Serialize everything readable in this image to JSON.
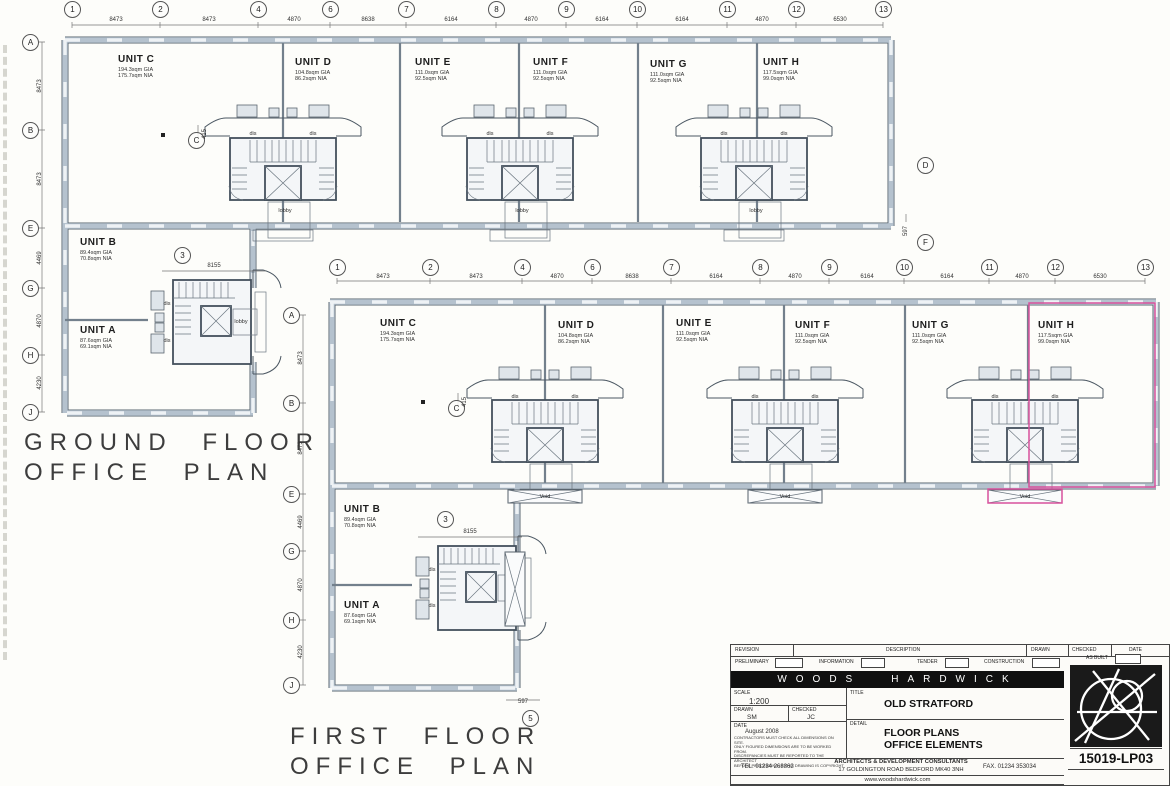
{
  "sheet": {
    "bg": "#fdfdfa",
    "line": "#3c3c3c",
    "wall_color": "#b5c2ce",
    "highlight_pink": "#d8519c"
  },
  "labels": {
    "dis": "dis",
    "lobby": "lobby",
    "void": "Void"
  },
  "plans": [
    {
      "id": "ground-floor",
      "title": {
        "line1": "GROUND FLOOR",
        "line2": "OFFICE PLAN",
        "x": 24,
        "y": 428
      },
      "bubbles": [
        {
          "label": "1",
          "x": 72,
          "y": 9
        },
        {
          "label": "2",
          "x": 160,
          "y": 9
        },
        {
          "label": "4",
          "x": 258,
          "y": 9
        },
        {
          "label": "6",
          "x": 330,
          "y": 9
        },
        {
          "label": "7",
          "x": 406,
          "y": 9
        },
        {
          "label": "8",
          "x": 496,
          "y": 9
        },
        {
          "label": "9",
          "x": 566,
          "y": 9
        },
        {
          "label": "10",
          "x": 637,
          "y": 9
        },
        {
          "label": "11",
          "x": 727,
          "y": 9
        },
        {
          "label": "12",
          "x": 796,
          "y": 9
        },
        {
          "label": "13",
          "x": 883,
          "y": 9
        },
        {
          "label": "A",
          "x": 30,
          "y": 42
        },
        {
          "label": "B",
          "x": 30,
          "y": 130
        },
        {
          "label": "E",
          "x": 30,
          "y": 228
        },
        {
          "label": "G",
          "x": 30,
          "y": 288
        },
        {
          "label": "H",
          "x": 30,
          "y": 355
        },
        {
          "label": "J",
          "x": 30,
          "y": 412
        },
        {
          "label": "D",
          "x": 925,
          "y": 165
        },
        {
          "label": "F",
          "x": 925,
          "y": 242
        },
        {
          "label": "3",
          "x": 182,
          "y": 255
        },
        {
          "label": "C",
          "x": 196,
          "y": 140
        }
      ],
      "dims": [
        {
          "v": "8473",
          "x": 116,
          "y": 20
        },
        {
          "v": "8473",
          "x": 209,
          "y": 20
        },
        {
          "v": "4870",
          "x": 294,
          "y": 20
        },
        {
          "v": "8638",
          "x": 368,
          "y": 20
        },
        {
          "v": "6164",
          "x": 451,
          "y": 20
        },
        {
          "v": "4870",
          "x": 531,
          "y": 20
        },
        {
          "v": "6164",
          "x": 602,
          "y": 20
        },
        {
          "v": "6164",
          "x": 682,
          "y": 20
        },
        {
          "v": "4870",
          "x": 762,
          "y": 20
        },
        {
          "v": "6530",
          "x": 840,
          "y": 20
        },
        {
          "v": "8473",
          "x": 40,
          "y": 86,
          "rot": 1
        },
        {
          "v": "8473",
          "x": 40,
          "y": 179,
          "rot": 1
        },
        {
          "v": "4469",
          "x": 40,
          "y": 258,
          "rot": 1
        },
        {
          "v": "4870",
          "x": 40,
          "y": 321,
          "rot": 1
        },
        {
          "v": "4230",
          "x": 40,
          "y": 383,
          "rot": 1
        },
        {
          "v": "8155",
          "x": 214,
          "y": 266
        },
        {
          "v": "597",
          "x": 906,
          "y": 231,
          "rot": 1
        },
        {
          "v": "415",
          "x": 205,
          "y": 134,
          "rot": 1
        }
      ],
      "units": [
        {
          "name": "UNIT C",
          "gia": "194.3sqm GIA",
          "nia": "175.7sqm NIA",
          "x": 118,
          "y": 54
        },
        {
          "name": "UNIT D",
          "gia": "104.8sqm GIA",
          "nia": "86.2sqm NIA",
          "x": 295,
          "y": 57
        },
        {
          "name": "UNIT E",
          "gia": "111.0sqm GIA",
          "nia": "92.5sqm NIA",
          "x": 415,
          "y": 57
        },
        {
          "name": "UNIT F",
          "gia": "111.0sqm GIA",
          "nia": "92.5sqm NIA",
          "x": 533,
          "y": 57
        },
        {
          "name": "UNIT G",
          "gia": "111.0sqm GIA",
          "nia": "92.5sqm NIA",
          "x": 650,
          "y": 59
        },
        {
          "name": "UNIT H",
          "gia": "117.5sqm GIA",
          "nia": "99.0sqm NIA",
          "x": 763,
          "y": 57
        },
        {
          "name": "UNIT B",
          "gia": "89.4sqm GIA",
          "nia": "70.8sqm NIA",
          "x": 80,
          "y": 237
        },
        {
          "name": "UNIT A",
          "gia": "87.6sqm GIA",
          "nia": "69.1sqm NIA",
          "x": 80,
          "y": 325
        }
      ],
      "texts": [
        {
          "t": "dis",
          "x": 253,
          "y": 134
        },
        {
          "t": "dis",
          "x": 313,
          "y": 134
        },
        {
          "t": "dis",
          "x": 490,
          "y": 134
        },
        {
          "t": "dis",
          "x": 550,
          "y": 134
        },
        {
          "t": "dis",
          "x": 724,
          "y": 134
        },
        {
          "t": "dis",
          "x": 784,
          "y": 134
        },
        {
          "t": "lobby",
          "x": 285,
          "y": 211
        },
        {
          "t": "lobby",
          "x": 522,
          "y": 211
        },
        {
          "t": "lobby",
          "x": 756,
          "y": 211
        },
        {
          "t": "dis",
          "x": 167,
          "y": 304
        },
        {
          "t": "dis",
          "x": 167,
          "y": 341
        },
        {
          "t": "lobby",
          "x": 241,
          "y": 322
        }
      ]
    },
    {
      "id": "first-floor",
      "title": {
        "line1": "FIRST FLOOR",
        "line2": "OFFICE PLAN",
        "x": 290,
        "y": 722
      },
      "bubbles": [
        {
          "label": "1",
          "x": 337,
          "y": 267
        },
        {
          "label": "2",
          "x": 430,
          "y": 267
        },
        {
          "label": "4",
          "x": 522,
          "y": 267
        },
        {
          "label": "6",
          "x": 592,
          "y": 267
        },
        {
          "label": "7",
          "x": 671,
          "y": 267
        },
        {
          "label": "8",
          "x": 760,
          "y": 267
        },
        {
          "label": "9",
          "x": 829,
          "y": 267
        },
        {
          "label": "10",
          "x": 904,
          "y": 267
        },
        {
          "label": "11",
          "x": 989,
          "y": 267
        },
        {
          "label": "12",
          "x": 1055,
          "y": 267
        },
        {
          "label": "13",
          "x": 1145,
          "y": 267
        },
        {
          "label": "A",
          "x": 291,
          "y": 315
        },
        {
          "label": "B",
          "x": 291,
          "y": 403
        },
        {
          "label": "E",
          "x": 291,
          "y": 494
        },
        {
          "label": "G",
          "x": 291,
          "y": 551
        },
        {
          "label": "H",
          "x": 291,
          "y": 620
        },
        {
          "label": "J",
          "x": 291,
          "y": 685
        },
        {
          "label": "C",
          "x": 456,
          "y": 408
        },
        {
          "label": "3",
          "x": 445,
          "y": 519
        },
        {
          "label": "5",
          "x": 530,
          "y": 718
        }
      ],
      "dims": [
        {
          "v": "8473",
          "x": 383,
          "y": 277
        },
        {
          "v": "8473",
          "x": 476,
          "y": 277
        },
        {
          "v": "4870",
          "x": 557,
          "y": 277
        },
        {
          "v": "8638",
          "x": 632,
          "y": 277
        },
        {
          "v": "6164",
          "x": 716,
          "y": 277
        },
        {
          "v": "4870",
          "x": 795,
          "y": 277
        },
        {
          "v": "6164",
          "x": 867,
          "y": 277
        },
        {
          "v": "6164",
          "x": 947,
          "y": 277
        },
        {
          "v": "4870",
          "x": 1022,
          "y": 277
        },
        {
          "v": "6530",
          "x": 1100,
          "y": 277
        },
        {
          "v": "8473",
          "x": 301,
          "y": 358,
          "rot": 1
        },
        {
          "v": "8473",
          "x": 301,
          "y": 448,
          "rot": 1
        },
        {
          "v": "4469",
          "x": 301,
          "y": 522,
          "rot": 1
        },
        {
          "v": "4870",
          "x": 301,
          "y": 585,
          "rot": 1
        },
        {
          "v": "4230",
          "x": 301,
          "y": 652,
          "rot": 1
        },
        {
          "v": "8155",
          "x": 470,
          "y": 532
        },
        {
          "v": "597",
          "x": 523,
          "y": 702
        },
        {
          "v": "415",
          "x": 465,
          "y": 402,
          "rot": 1
        }
      ],
      "units": [
        {
          "name": "UNIT C",
          "gia": "194.3sqm GIA",
          "nia": "175.7sqm NIA",
          "x": 380,
          "y": 318
        },
        {
          "name": "UNIT D",
          "gia": "104.8sqm GIA",
          "nia": "86.2sqm NIA",
          "x": 558,
          "y": 320
        },
        {
          "name": "UNIT E",
          "gia": "111.0sqm GIA",
          "nia": "92.5sqm NIA",
          "x": 676,
          "y": 318
        },
        {
          "name": "UNIT F",
          "gia": "111.0sqm GIA",
          "nia": "92.5sqm NIA",
          "x": 795,
          "y": 320
        },
        {
          "name": "UNIT G",
          "gia": "111.0sqm GIA",
          "nia": "92.5sqm NIA",
          "x": 912,
          "y": 320
        },
        {
          "name": "UNIT H",
          "gia": "117.5sqm GIA",
          "nia": "99.0sqm NIA",
          "x": 1038,
          "y": 320
        },
        {
          "name": "UNIT B",
          "gia": "89.4sqm GIA",
          "nia": "70.8sqm NIA",
          "x": 344,
          "y": 504
        },
        {
          "name": "UNIT A",
          "gia": "87.6sqm GIA",
          "nia": "69.1sqm NIA",
          "x": 344,
          "y": 600
        }
      ],
      "texts": [
        {
          "t": "dis",
          "x": 515,
          "y": 397
        },
        {
          "t": "dis",
          "x": 575,
          "y": 397
        },
        {
          "t": "dis",
          "x": 755,
          "y": 397
        },
        {
          "t": "dis",
          "x": 815,
          "y": 397
        },
        {
          "t": "dis",
          "x": 995,
          "y": 397
        },
        {
          "t": "dis",
          "x": 1055,
          "y": 397
        },
        {
          "t": "Void",
          "x": 545,
          "y": 497
        },
        {
          "t": "Void",
          "x": 785,
          "y": 497
        },
        {
          "t": "Void",
          "x": 1025,
          "y": 497
        },
        {
          "t": "dis",
          "x": 432,
          "y": 570
        },
        {
          "t": "dis",
          "x": 432,
          "y": 606
        }
      ]
    }
  ],
  "titleblock": {
    "revision_label": "REVISION",
    "description_label": "DESCRIPTION",
    "drawn_label": "DRAWN",
    "checked_label": "CHECKED",
    "date_label": "DATE",
    "statuses": [
      "PRELIMINARY",
      "INFORMATION",
      "TENDER",
      "CONSTRUCTION",
      "AS BUILT"
    ],
    "firm_word1": "WOODS",
    "firm_word2": "HARDWICK",
    "scale_label": "SCALE",
    "scale_value": "1:200",
    "title_label": "TITLE",
    "project_title": "OLD STRATFORD",
    "drawn_value": "SM",
    "checked_value": "JC",
    "date_value": "August 2008",
    "detail_label": "DETAIL",
    "drawing_title_1": "FLOOR PLANS",
    "drawing_title_2": "OFFICE ELEMENTS",
    "disclaimer_1": "CONTRACTORS MUST CHECK ALL DIMENSIONS ON SITE.",
    "disclaimer_2": "ONLY FIGURED DIMENSIONS ARE TO BE WORKED FROM.",
    "disclaimer_3": "DISCREPANCIES MUST BE REPORTED TO THE ARCHITECT",
    "disclaimer_4": "BEFORE PROCEEDING.  © THIS DRAWING IS COPYRIGHT",
    "tel": "TEL. 01234 268862",
    "consultants_1": "ARCHITECTS & DEVELOPMENT CONSULTANTS",
    "consultants_2": "17 GOLDINGTON ROAD BEDFORD MK40 3NH",
    "fax": "FAX. 01234 353034",
    "drawing_number": "15019-LP03",
    "website": "www.woodshardwick.com"
  }
}
